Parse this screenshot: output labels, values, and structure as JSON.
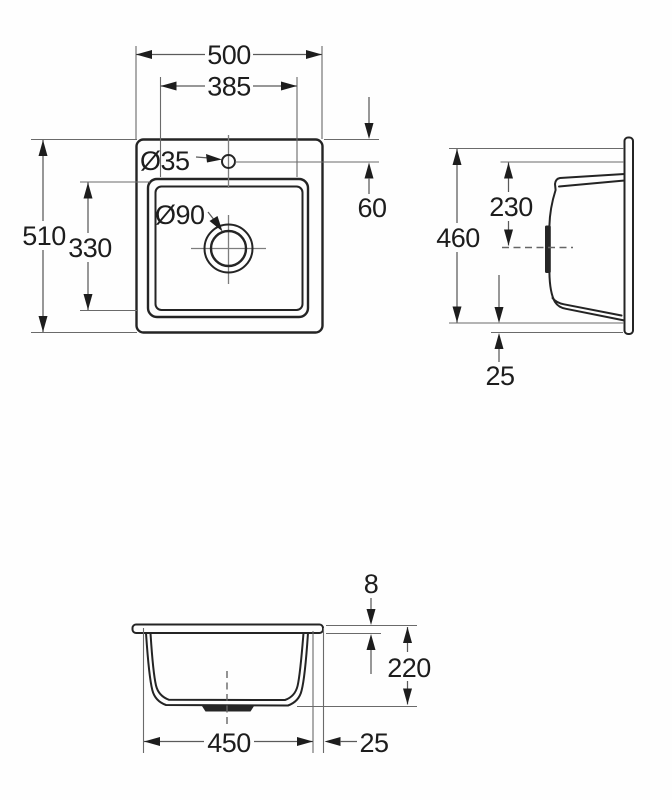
{
  "drawing": {
    "type": "sink-installation-dimension-diagram",
    "views": [
      "plan-view",
      "side-view",
      "front-view"
    ],
    "colors": {
      "background": "#fefefe",
      "outline": "#242424",
      "dimension_lines": "#5a5a5a",
      "centerline": "#7d7d7d",
      "text": "#1d1d1d"
    },
    "plan": {
      "overall_width": "500",
      "bowl_opening_width": "385",
      "tap_hole_diameter": "Ø35",
      "tap_hole_offset": "60",
      "overall_depth": "510",
      "bowl_opening_depth": "330",
      "drain_diameter": "Ø90"
    },
    "side": {
      "cutout_length": "460",
      "tap_line_to_center": "230",
      "edge_margin": "25"
    },
    "front": {
      "rim_thickness": "8",
      "bowl_depth": "220",
      "bowl_width": "450",
      "rim_overhang": "25"
    }
  }
}
